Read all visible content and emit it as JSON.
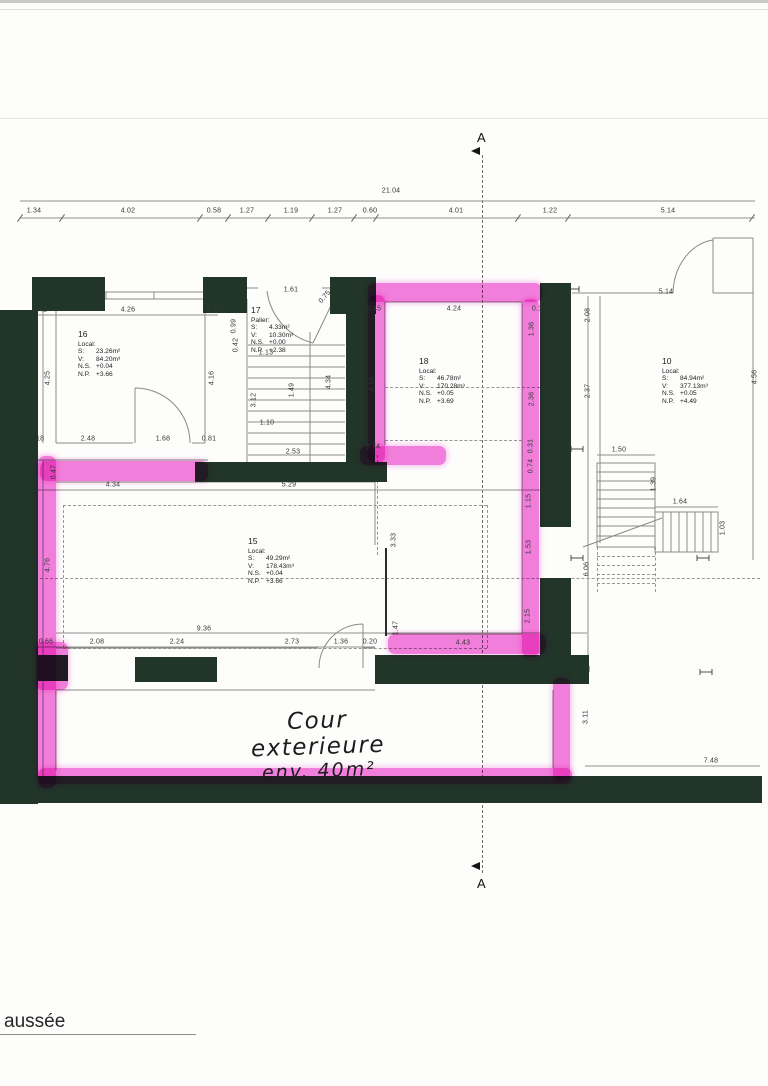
{
  "colors": {
    "wall": "#223529",
    "highlighter_pink": "#f25fd6",
    "line_gray": "#8f8f8d",
    "text": "#353535"
  },
  "section": {
    "label_top": "A",
    "label_bottom": "A"
  },
  "title_block": {
    "partial_text": "aussée"
  },
  "annotations": {
    "courtyard_line1": "Cour exterieure",
    "courtyard_line2": "env. 40m²"
  },
  "rooms": {
    "r16": {
      "num": "16",
      "kind": "Local:",
      "rows": [
        [
          "S:",
          "23.26m²"
        ],
        [
          "V:",
          "84.20m³"
        ],
        [
          "N.S.",
          "+0.04"
        ],
        [
          "N.P.",
          "+3.66"
        ]
      ]
    },
    "r17": {
      "num": "17",
      "kind": "Palier:",
      "rows": [
        [
          "S:",
          "4.33m²"
        ],
        [
          "V:",
          "10.30m³"
        ],
        [
          "N.S.",
          "+0.00"
        ],
        [
          "N.P.",
          "+2.38"
        ]
      ]
    },
    "r18": {
      "num": "18",
      "kind": "Local:",
      "rows": [
        [
          "S:",
          "46.78m²"
        ],
        [
          "V:",
          "170.28m³"
        ],
        [
          "N.S.",
          "+0.05"
        ],
        [
          "N.P.",
          "+3.69"
        ]
      ]
    },
    "r15": {
      "num": "15",
      "kind": "Local:",
      "rows": [
        [
          "S:",
          "49.29m²"
        ],
        [
          "V:",
          "178.43m³"
        ],
        [
          "N.S.",
          "+0.04"
        ],
        [
          "N.P.",
          "+3.66"
        ]
      ]
    },
    "r10": {
      "num": "10",
      "kind": "Local:",
      "rows": [
        [
          "S:",
          "84.94m²"
        ],
        [
          "V:",
          "377.13m³"
        ],
        [
          "N.S.",
          "+0.05"
        ],
        [
          "N.P.",
          "+4.49"
        ]
      ]
    }
  },
  "dims": [
    {
      "v": "21.04",
      "x": 391,
      "y": 191
    },
    {
      "v": "1.34",
      "x": 34,
      "y": 211
    },
    {
      "v": "4.02",
      "x": 128,
      "y": 211
    },
    {
      "v": "0.58",
      "x": 214,
      "y": 211
    },
    {
      "v": "1.27",
      "x": 247,
      "y": 211
    },
    {
      "v": "1.19",
      "x": 291,
      "y": 211
    },
    {
      "v": "1.27",
      "x": 335,
      "y": 211
    },
    {
      "v": "0.60",
      "x": 370,
      "y": 211
    },
    {
      "v": "4.01",
      "x": 456,
      "y": 211
    },
    {
      "v": "1.22",
      "x": 550,
      "y": 211
    },
    {
      "v": "5.14",
      "x": 668,
      "y": 211
    },
    {
      "v": "0.42",
      "x": 40,
      "y": 310
    },
    {
      "v": "4.26",
      "x": 128,
      "y": 310
    },
    {
      "v": "0.49",
      "x": 214,
      "y": 310
    },
    {
      "v": "1.61",
      "x": 291,
      "y": 290
    },
    {
      "v": "0.75",
      "x": 325,
      "y": 297,
      "r": -50
    },
    {
      "v": "0.45",
      "x": 374,
      "y": 309
    },
    {
      "v": "4.24",
      "x": 454,
      "y": 309
    },
    {
      "v": "0.1",
      "x": 537,
      "y": 309
    },
    {
      "v": "5.14",
      "x": 666,
      "y": 292
    },
    {
      "v": "0.99",
      "x": 234,
      "y": 326,
      "r": -90
    },
    {
      "v": "0.42",
      "x": 236,
      "y": 345,
      "r": -90
    },
    {
      "v": "4.25",
      "x": 48,
      "y": 378,
      "r": -90
    },
    {
      "v": "4.16",
      "x": 212,
      "y": 378,
      "r": -90
    },
    {
      "v": "1.13",
      "x": 266,
      "y": 353
    },
    {
      "v": "3.12",
      "x": 254,
      "y": 400,
      "r": -90
    },
    {
      "v": "1.49",
      "x": 292,
      "y": 390,
      "r": -90
    },
    {
      "v": "4.34",
      "x": 329,
      "y": 382,
      "r": -90
    },
    {
      "v": "1.10",
      "x": 267,
      "y": 423
    },
    {
      "v": "2.53",
      "x": 293,
      "y": 452
    },
    {
      "v": "4.16",
      "x": 372,
      "y": 384,
      "r": -90
    },
    {
      "v": "1.36",
      "x": 532,
      "y": 329,
      "r": -90
    },
    {
      "v": "2.36",
      "x": 532,
      "y": 399,
      "r": -90
    },
    {
      "v": "0.31",
      "x": 531,
      "y": 446,
      "r": -90
    },
    {
      "v": "0.74",
      "x": 531,
      "y": 466,
      "r": -90
    },
    {
      "v": "1.15",
      "x": 529,
      "y": 501,
      "r": -90
    },
    {
      "v": "1.53",
      "x": 529,
      "y": 547,
      "r": -90
    },
    {
      "v": "2.15",
      "x": 528,
      "y": 616,
      "r": -90
    },
    {
      "v": "2.08",
      "x": 588,
      "y": 315,
      "r": -90
    },
    {
      "v": "2.37",
      "x": 588,
      "y": 391,
      "r": -90
    },
    {
      "v": "4.56",
      "x": 755,
      "y": 377,
      "r": -90
    },
    {
      "v": ".18",
      "x": 39,
      "y": 439
    },
    {
      "v": "2.48",
      "x": 88,
      "y": 439
    },
    {
      "v": "1.68",
      "x": 163,
      "y": 439
    },
    {
      "v": "0.81",
      "x": 209,
      "y": 439
    },
    {
      "v": "0.47",
      "x": 54,
      "y": 472,
      "r": -90
    },
    {
      "v": "4.34",
      "x": 113,
      "y": 485
    },
    {
      "v": "5.29",
      "x": 289,
      "y": 485
    },
    {
      "v": "0.74",
      "x": 373,
      "y": 447
    },
    {
      "v": "1.50",
      "x": 619,
      "y": 450
    },
    {
      "v": "1.39",
      "x": 654,
      "y": 484,
      "r": -90
    },
    {
      "v": "1.64",
      "x": 680,
      "y": 502
    },
    {
      "v": "1.03",
      "x": 723,
      "y": 528,
      "r": -90
    },
    {
      "v": "6.06",
      "x": 587,
      "y": 569,
      "r": -90
    },
    {
      "v": "4.76",
      "x": 48,
      "y": 565,
      "r": -90
    },
    {
      "v": "3.33",
      "x": 394,
      "y": 540,
      "r": -90
    },
    {
      "v": "9.36",
      "x": 204,
      "y": 629
    },
    {
      "v": "0.66",
      "x": 46,
      "y": 642
    },
    {
      "v": "2.08",
      "x": 97,
      "y": 642
    },
    {
      "v": "2.24",
      "x": 177,
      "y": 642
    },
    {
      "v": "2.73",
      "x": 292,
      "y": 642
    },
    {
      "v": "1.36",
      "x": 341,
      "y": 642
    },
    {
      "v": "0.20",
      "x": 370,
      "y": 642
    },
    {
      "v": "1.47",
      "x": 396,
      "y": 628,
      "r": -90
    },
    {
      "v": "4.43",
      "x": 463,
      "y": 643
    },
    {
      "v": "3.11",
      "x": 586,
      "y": 717,
      "r": -90
    },
    {
      "v": "7.48",
      "x": 711,
      "y": 761
    }
  ],
  "chain_ticks": [
    20,
    62,
    200,
    228,
    268,
    312,
    354,
    376,
    518,
    568,
    752
  ]
}
